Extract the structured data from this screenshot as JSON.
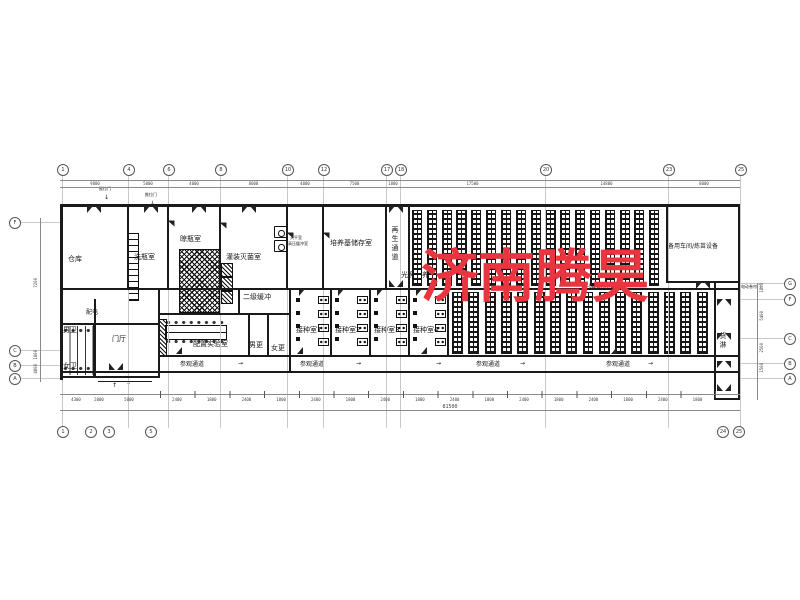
{
  "watermark": {
    "text": "济南腾昊",
    "color": "#e8353f"
  },
  "rooms": {
    "warehouse": "仓库",
    "bottle_wash": "洗瓶室",
    "bottle_dry": "晾瓶室",
    "filling_sterilize": "灌装灭菌室",
    "balance": "天平室",
    "pressure_buffer": "高压缓冲室",
    "medium_storage": "培养基储存室",
    "regen_corridor": "再生通道",
    "light_culture_upper": "光照培养室",
    "light_culture_lower": "光照培养室",
    "spare_workshop": "备用车间/炼苗设备",
    "power": "配电",
    "male_wc": "男卫",
    "female_wc": "女卫",
    "lobby": "门厅",
    "prep_lab": "配置实验室",
    "secondary_buffer": "二级缓冲",
    "male_change": "男更",
    "female_change": "女更",
    "inoculation_1": "接种室1",
    "inoculation_2": "接种室2",
    "inoculation_3": "接种室3",
    "inoculation_4": "接种室4",
    "goods_shower": "货淋"
  },
  "labels": {
    "corridor": "参观通道",
    "sliding_door": "推拉门",
    "rolling_door": "电动卷帘门",
    "arrow_right": "→",
    "arrow_down": "↓",
    "arrow_up": "↑"
  },
  "grid": {
    "top": [
      "1",
      "4",
      "6",
      "8",
      "10",
      "12",
      "17",
      "18",
      "20",
      "23",
      "25"
    ],
    "bottom": [
      "1",
      "2",
      "3",
      "5",
      "24",
      "25"
    ],
    "left": [
      "F",
      "C",
      "B",
      "A"
    ],
    "right": [
      "G",
      "F",
      "C",
      "B",
      "A"
    ]
  },
  "dims": {
    "top": [
      "9800",
      "5000",
      "4000",
      "8000",
      "4000",
      "7500",
      "1800",
      "17500",
      "14800",
      "8000"
    ],
    "bottom_left": [
      "4300",
      "2000",
      "5000"
    ],
    "bottom_small": [
      "2400",
      "1800",
      "2400",
      "1800",
      "2400",
      "1800",
      "2400",
      "1800",
      "2400",
      "1800",
      "2400",
      "1800",
      "2400",
      "1800",
      "2400",
      "1800"
    ],
    "bottom_total": "81500",
    "left": [
      "7200",
      "1800",
      "4800"
    ],
    "right": [
      "1800",
      "5400",
      "2500",
      "1500"
    ]
  },
  "racks": {
    "upper_count": 17,
    "lower_count": 16
  }
}
